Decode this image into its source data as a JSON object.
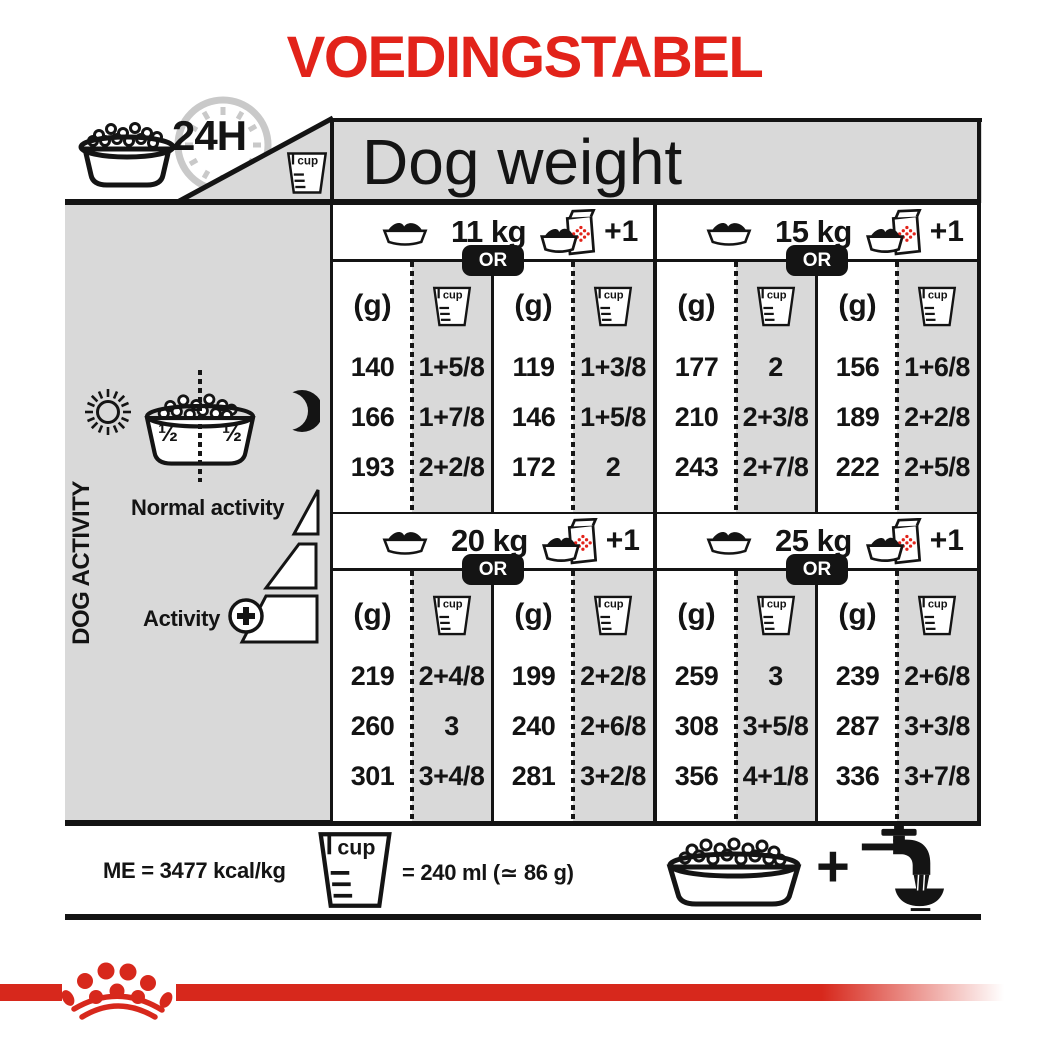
{
  "title": "VOEDINGSTABEL",
  "header": {
    "h24": "24H",
    "dog_weight": "Dog weight",
    "cup": "cup"
  },
  "sidebar": {
    "dog_activity": "DOG ACTIVITY",
    "half_left": "½",
    "half_right": "½",
    "normal_activity": "Normal activity",
    "activity": "Activity"
  },
  "table": {
    "or": "OR",
    "plus_one": "+1",
    "grams": "(g)",
    "cup": "cup",
    "blocks": [
      {
        "weight": "11 kg",
        "rows": [
          [
            "140",
            "1+5/8",
            "119",
            "1+3/8"
          ],
          [
            "166",
            "1+7/8",
            "146",
            "1+5/8"
          ],
          [
            "193",
            "2+2/8",
            "172",
            "2"
          ]
        ]
      },
      {
        "weight": "15 kg",
        "rows": [
          [
            "177",
            "2",
            "156",
            "1+6/8"
          ],
          [
            "210",
            "2+3/8",
            "189",
            "2+2/8"
          ],
          [
            "243",
            "2+7/8",
            "222",
            "2+5/8"
          ]
        ]
      },
      {
        "weight": "20 kg",
        "rows": [
          [
            "219",
            "2+4/8",
            "199",
            "2+2/8"
          ],
          [
            "260",
            "3",
            "240",
            "2+6/8"
          ],
          [
            "301",
            "3+4/8",
            "281",
            "3+2/8"
          ]
        ]
      },
      {
        "weight": "25 kg",
        "rows": [
          [
            "259",
            "3",
            "239",
            "2+6/8"
          ],
          [
            "308",
            "3+5/8",
            "287",
            "3+3/8"
          ],
          [
            "356",
            "4+1/8",
            "336",
            "3+7/8"
          ]
        ]
      }
    ]
  },
  "footer": {
    "me": "ME = 3477 kcal/kg",
    "cup": "cup",
    "equivalence": "= 240 ml (≃ 86 g)",
    "plus": "+"
  },
  "icons": {
    "bowl": "dog-food-bowl",
    "cup": "measuring-cup",
    "clock": "24h-clock",
    "sun": "sun",
    "moon": "moon",
    "pack": "bowl-plus-kibble-pack",
    "tap": "water-tap-with-bowl",
    "crown": "royal-canin-crown"
  },
  "colors": {
    "title_red": "#e2231a",
    "brand_red": "#d7281c",
    "panel_gray": "#d9d9d9",
    "ink": "#141414"
  }
}
